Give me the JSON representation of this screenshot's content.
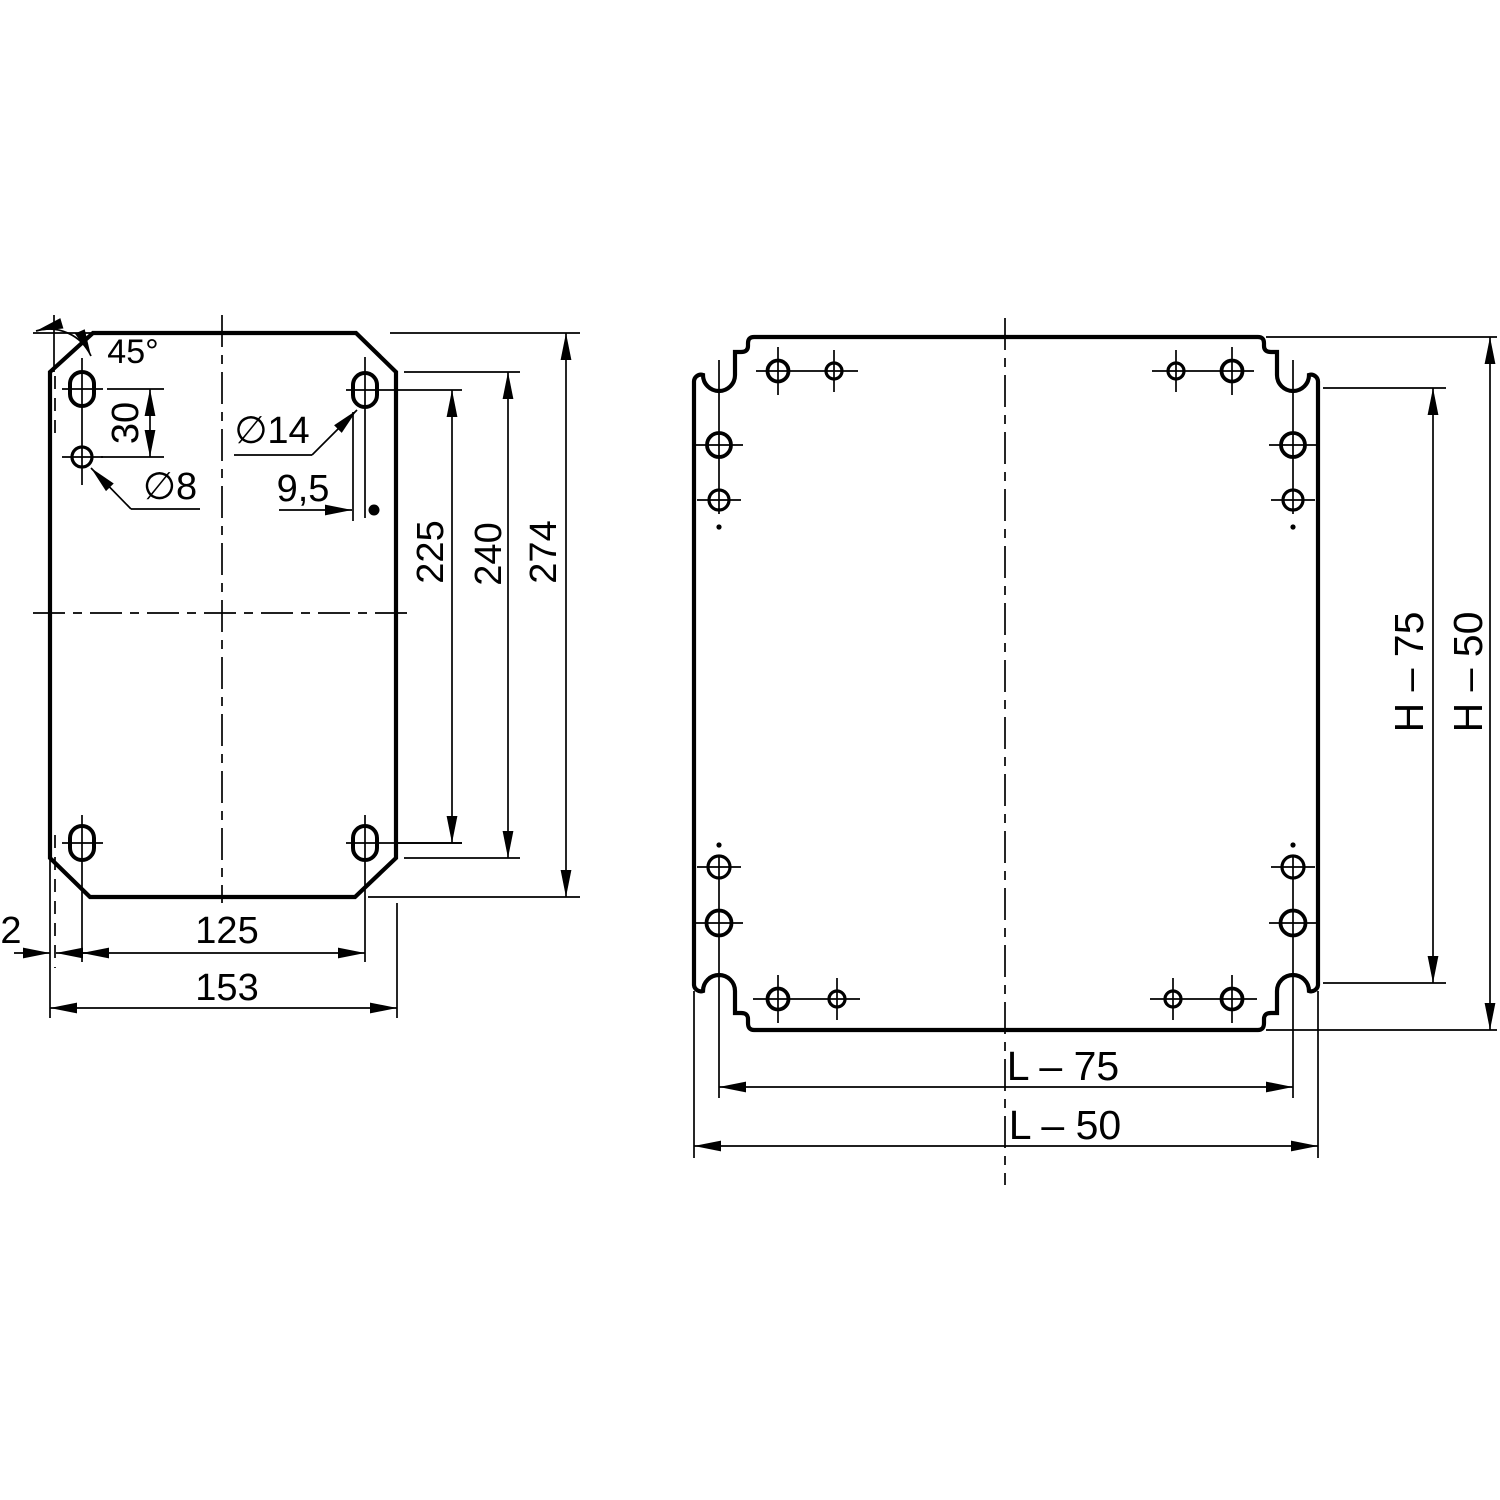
{
  "drawing": {
    "colors": {
      "ink": "#000000",
      "paper": "#ffffff"
    },
    "labels": {
      "left": {
        "angle": "45°",
        "d30": "30",
        "d8": "∅8",
        "d14": "∅14",
        "d95": "9,5",
        "d225": "225",
        "d240": "240",
        "d274": "274",
        "d2": "2",
        "d125": "125",
        "d153": "153"
      },
      "right": {
        "l75": "L – 75",
        "l50": "L – 50",
        "h75": "H – 75",
        "h50": "H – 50"
      }
    }
  }
}
